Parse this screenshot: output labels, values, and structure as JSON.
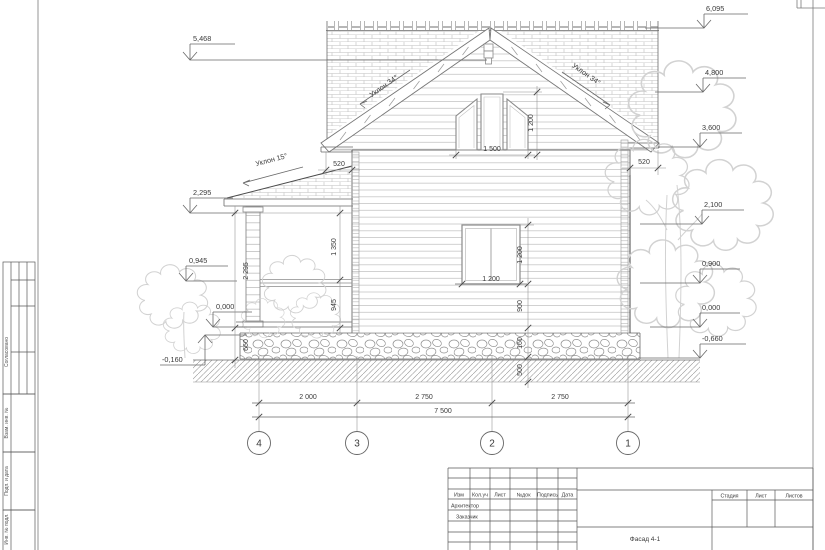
{
  "sheet": {
    "name": "Фасад 4-1"
  },
  "elev": {
    "left": [
      "5,468",
      "2,295",
      "0,945",
      "0,000",
      "-0,160"
    ],
    "right": [
      "6,095",
      "4,800",
      "3,600",
      "2,100",
      "0,900",
      "0,000",
      "-0,660"
    ]
  },
  "slopes": {
    "left": "Уклон 34°",
    "right": "Уклон 34°",
    "porch": "Уклон 15°"
  },
  "dims": {
    "eave_l": "520",
    "eave_r": "520",
    "attic_w": "1 500",
    "attic_h": "1 200",
    "win_w": "1 200",
    "win_h": "1 200",
    "sill": "900",
    "plinth": "160",
    "footing": "500",
    "porch_h": "2 295",
    "porch_top": "1 350",
    "porch_rail": "945",
    "porch_base": "660",
    "bay_43": "2 000",
    "bay_32": "2 750",
    "bay_21": "2 750",
    "total": "7 500"
  },
  "axes": [
    "4",
    "3",
    "2",
    "1"
  ],
  "margin": {
    "labels": [
      "Согласовано",
      "Взам. инв. №",
      "Подп. и дата",
      "Инв. № подл."
    ]
  },
  "titleblock": {
    "cols": [
      "Изм",
      "Кол.уч",
      "Лист",
      "№док",
      "Подпись",
      "Дата"
    ],
    "roles": [
      "Архитектор",
      "Заказчик"
    ],
    "stage": "Стадия",
    "sheet": "Лист",
    "sheets": "Листов",
    "title": "Фасад 4-1"
  }
}
